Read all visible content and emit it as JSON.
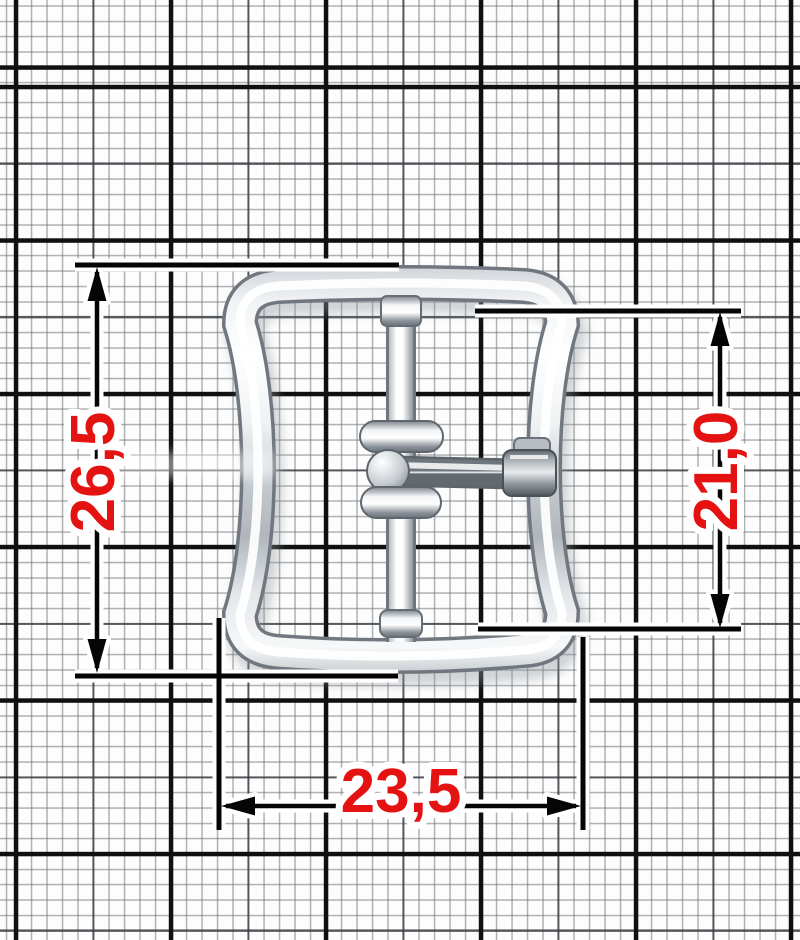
{
  "scene": {
    "description": "Polished metal strap buckle with center bar, two rollers and a tongue pin, photographed on millimetre graph paper with red dimension callouts",
    "object_name": "strap-buckle"
  },
  "paper": {
    "background_color": "#fdfdfd",
    "fine_line_color": "#6e7276",
    "medium_line_color": "#3a3e42",
    "heavy_line_color": "#101010",
    "fine_step_mm": 1,
    "medium_step_mm": 5,
    "heavy_step_mm": 10
  },
  "buckle": {
    "finish_color_light": "#ffffff",
    "finish_color_mid": "#c2c8cd",
    "finish_color_dark": "#70777e",
    "parts": [
      "outer frame",
      "center bar",
      "upper roller",
      "lower roller",
      "tongue pin"
    ]
  },
  "dimensions": {
    "text_color": "#e51212",
    "line_color": "#050505",
    "halo_color": "#ffffff",
    "height_outer": {
      "label": "26,5",
      "side": "left",
      "orientation": "vertical"
    },
    "height_inner": {
      "label": "21,0",
      "side": "right",
      "orientation": "vertical"
    },
    "width_bottom": {
      "label": "23,5",
      "side": "bottom",
      "orientation": "horizontal"
    }
  }
}
